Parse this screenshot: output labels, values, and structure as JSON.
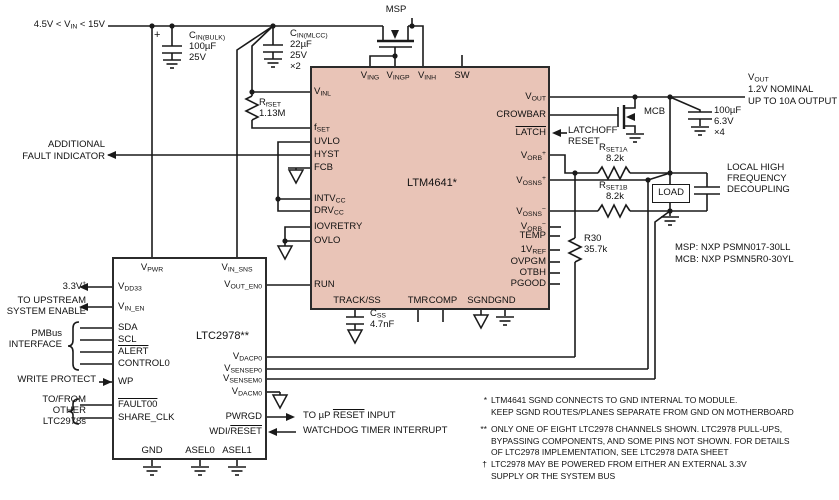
{
  "colors": {
    "module_fill": "#e9c4b7",
    "wire": "#1a1a1a",
    "background": "#ffffff"
  },
  "input": {
    "label": "4.5V < V_{IN} < 15V"
  },
  "components": {
    "cin_bulk": {
      "plus": "+",
      "name": "C_{IN(BULK)}",
      "value": "100µF",
      "voltage": "25V"
    },
    "cin_mlcc": {
      "name": "C_{IN(MLCC)}",
      "value": "22µF",
      "voltage": "25V",
      "qty": "×2"
    },
    "rfset": {
      "name": "R_{fSET}",
      "value": "1.13M"
    },
    "msp": {
      "label": "MSP"
    },
    "mcb": {
      "label": "MCB"
    },
    "rset1a": {
      "name": "R_{SET1A}",
      "value": "8.2k"
    },
    "rset1b": {
      "name": "R_{SET1B}",
      "value": "8.2k"
    },
    "r30": {
      "name": "R30",
      "value": "35.7k"
    },
    "cout": {
      "value": "100µF",
      "voltage": "6.3V",
      "qty": "×4"
    },
    "css": {
      "name": "C_{SS}",
      "value": "4.7nF"
    },
    "load": {
      "label": "LOAD"
    }
  },
  "ltm4641": {
    "name": "LTM4641*",
    "pins_top": [
      "V_{ING}",
      "V_{INGP}",
      "V_{INH}",
      "SW"
    ],
    "pins_left": [
      "V_{INL}",
      "f_{SET}",
      "UVLO",
      "HYST",
      "FCB",
      "INTV_{CC}",
      "DRV_{CC}",
      "IOVRETRY",
      "OVLO",
      "RUN"
    ],
    "pins_right": [
      "V_{OUT}",
      "CROWBAR",
      "~{LATCH}",
      "V_{ORB}^{+}",
      "V_{OSNS}^{+}",
      "V_{OSNS}^{−}",
      "V_{ORB}^{−}",
      "TEMP",
      "1V_{REF}",
      "OVPGM",
      "OTBH",
      "PGOOD"
    ],
    "pins_bottom": [
      "TRACK/SS",
      "TMR",
      "COMP",
      "SGND",
      "GND"
    ]
  },
  "ltc2978": {
    "name": "LTC2978**",
    "pins_top": [
      "V_{PWR}",
      "V_{IN_SNS}"
    ],
    "pins_left": [
      "V_{DD33}",
      "V_{IN_EN}",
      "SDA",
      "SCL",
      "~{ALERT}",
      "CONTROL0",
      "WP",
      "~{FAULT00}",
      "SHARE_CLK"
    ],
    "pins_right": [
      "V_{OUT_EN0}",
      "V_{DACP0}",
      "V_{SENSEP0}",
      "V_{SENSEM0}",
      "V_{DACM0}",
      "PWRGD",
      "WDI/~{RESET}"
    ],
    "pins_bottom": [
      "GND",
      "ASEL0",
      "ASEL1"
    ]
  },
  "annotations": {
    "fault_indicator": [
      "ADDITIONAL",
      "FAULT INDICATOR"
    ],
    "vout": [
      "V_{OUT}",
      "1.2V NOMINAL",
      "UP TO 10A OUTPUT"
    ],
    "latchoff": [
      "LATCHOFF",
      "RESET"
    ],
    "decoupling": [
      "LOCAL HIGH",
      "FREQUENCY",
      "DECOUPLING"
    ],
    "fet_types": [
      "MSP: NXP PSMN017-30LL",
      "MCB: NXP PSMN5R0-30YL"
    ],
    "v33": "3.3V^{†}",
    "upstream": [
      "TO UPSTREAM",
      "SYSTEM ENABLE"
    ],
    "pmbus": [
      "PMBus",
      "INTERFACE"
    ],
    "write_protect": "WRITE PROTECT",
    "tofrom": [
      "TO/FROM",
      "OTHER",
      "LTC2978s"
    ],
    "reset_input": "TO µP ~{RESET} INPUT",
    "watchdog": "WATCHDOG TIMER INTERRUPT"
  },
  "notes": [
    {
      "mark": "*",
      "lines": [
        "LTM4641 SGND CONNECTS TO GND INTERNAL TO MODULE.",
        "KEEP SGND ROUTES/PLANES SEPARATE FROM GND ON MOTHERBOARD"
      ]
    },
    {
      "mark": "**",
      "lines": [
        "ONLY ONE OF EIGHT LTC2978 CHANNELS SHOWN. LTC2978 PULL-UPS,",
        "BYPASSING COMPONENTS, AND SOME PINS NOT SHOWN. FOR DETAILS",
        "OF LTC2978 IMPLEMENTATION, SEE LTC2978 DATA SHEET"
      ]
    },
    {
      "mark": "†",
      "lines": [
        "LTC2978 MAY BE POWERED FROM EITHER AN EXTERNAL 3.3V",
        "SUPPLY OR THE SYSTEM BUS"
      ]
    }
  ]
}
